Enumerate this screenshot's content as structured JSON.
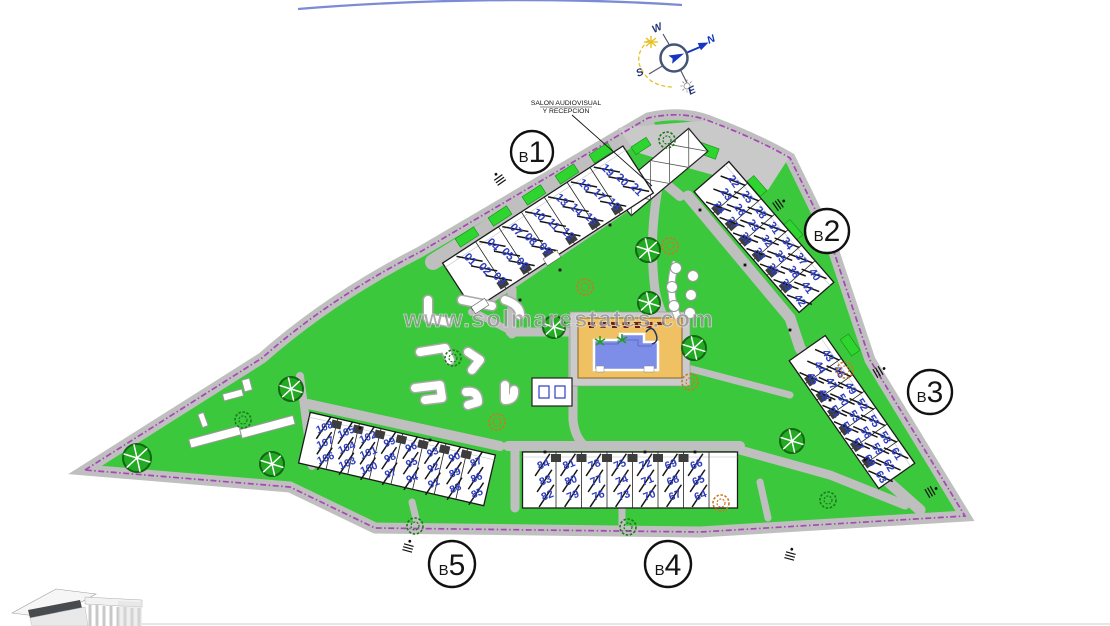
{
  "watermark": "www.solmarestates.com",
  "annotation": {
    "line1": "SALON AUDIOVISUAL",
    "line2": "Y RECEPCION"
  },
  "compass": {
    "n": "N",
    "e": "E",
    "s": "S",
    "w": "W"
  },
  "blocks": [
    {
      "id": "b1",
      "letter": "B",
      "number": "1",
      "units": [
        [
          "01",
          "02",
          "03"
        ],
        [
          "04",
          "05",
          "06"
        ],
        [
          "07",
          "08",
          "09"
        ],
        [
          "10",
          "11",
          "12"
        ],
        [
          "13",
          "14",
          "15"
        ],
        [
          "16",
          "17",
          "18"
        ],
        [
          "19",
          "20",
          "21"
        ]
      ]
    },
    {
      "id": "b2",
      "letter": "B",
      "number": "2",
      "units": [
        [
          "22",
          "23",
          "24"
        ],
        [
          "25",
          "26",
          "27"
        ],
        [
          "28",
          "29",
          "30"
        ],
        [
          "31",
          "32",
          "33"
        ],
        [
          "34",
          "35",
          "36"
        ],
        [
          "37",
          "38",
          "39"
        ],
        [
          "40",
          "41",
          "42"
        ]
      ]
    },
    {
      "id": "b3",
      "letter": "B",
      "number": "3",
      "units": [
        [
          "43",
          "44",
          "45"
        ],
        [
          "46",
          "47",
          "48"
        ],
        [
          "49",
          "50",
          "51"
        ],
        [
          "52",
          "53",
          "54"
        ],
        [
          "55",
          "56",
          "57"
        ],
        [
          "58",
          "59",
          "60"
        ],
        [
          "61",
          "62",
          "63"
        ]
      ]
    },
    {
      "id": "b4",
      "letter": "B",
      "number": "4",
      "units": [
        [
          "84",
          "83",
          "82"
        ],
        [
          "81",
          "80",
          "79"
        ],
        [
          "78",
          "77",
          "76"
        ],
        [
          "75",
          "74",
          "73"
        ],
        [
          "72",
          "71",
          "70"
        ],
        [
          "69",
          "68",
          "67"
        ],
        [
          "66",
          "65",
          "64"
        ]
      ]
    },
    {
      "id": "b5",
      "letter": "B",
      "number": "5",
      "units": [
        [
          "108",
          "107",
          "106"
        ],
        [
          "105",
          "104",
          "103"
        ],
        [
          "102",
          "101",
          "100"
        ],
        [
          "99",
          "98",
          "97"
        ],
        [
          "96",
          "95",
          "94"
        ],
        [
          "93",
          "92",
          "91"
        ],
        [
          "90",
          "89",
          "88"
        ],
        [
          "87",
          "86",
          "85"
        ]
      ]
    }
  ],
  "colors": {
    "site_green": "#3CC83C",
    "hedge_green": "#2ED52E",
    "road_gray": "#BFBFBF",
    "boundary_purple": "#A845B8",
    "unit_blue": "#2E3EC0",
    "pool_water": "#7D8EE8",
    "pool_deck": "#EFC163",
    "tree_green": "#22AA22",
    "compass_blue": "#1536C0",
    "watermark_gray": "#969696"
  }
}
